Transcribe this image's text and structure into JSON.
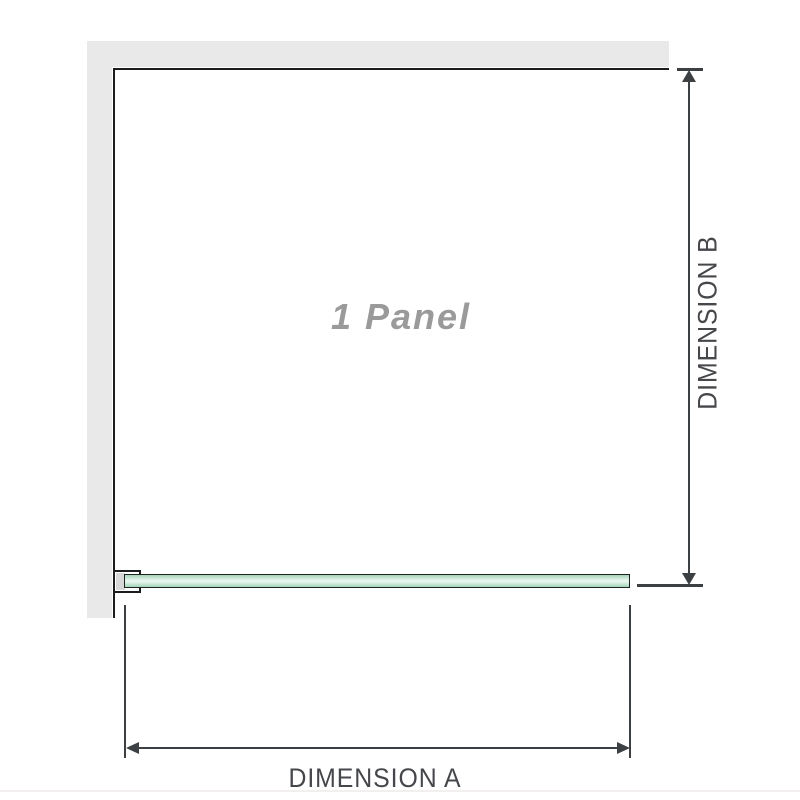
{
  "diagram": {
    "panel_label": "1 Panel",
    "dimension_a_label": "DIMENSION A",
    "dimension_b_label": "DIMENSION B"
  },
  "colors": {
    "wall": "#e9e9e9",
    "panel_border": "#1c1c1c",
    "bracket_fill": "#d8d8d8",
    "glass_outline": "#222222",
    "glass_green_edge": "#a2d3b7",
    "glass_green_center": "#eef8f2",
    "dimension_line": "#3d4043",
    "dimension_text": "#45474a",
    "panel_label_text": "#9a9a9a"
  }
}
